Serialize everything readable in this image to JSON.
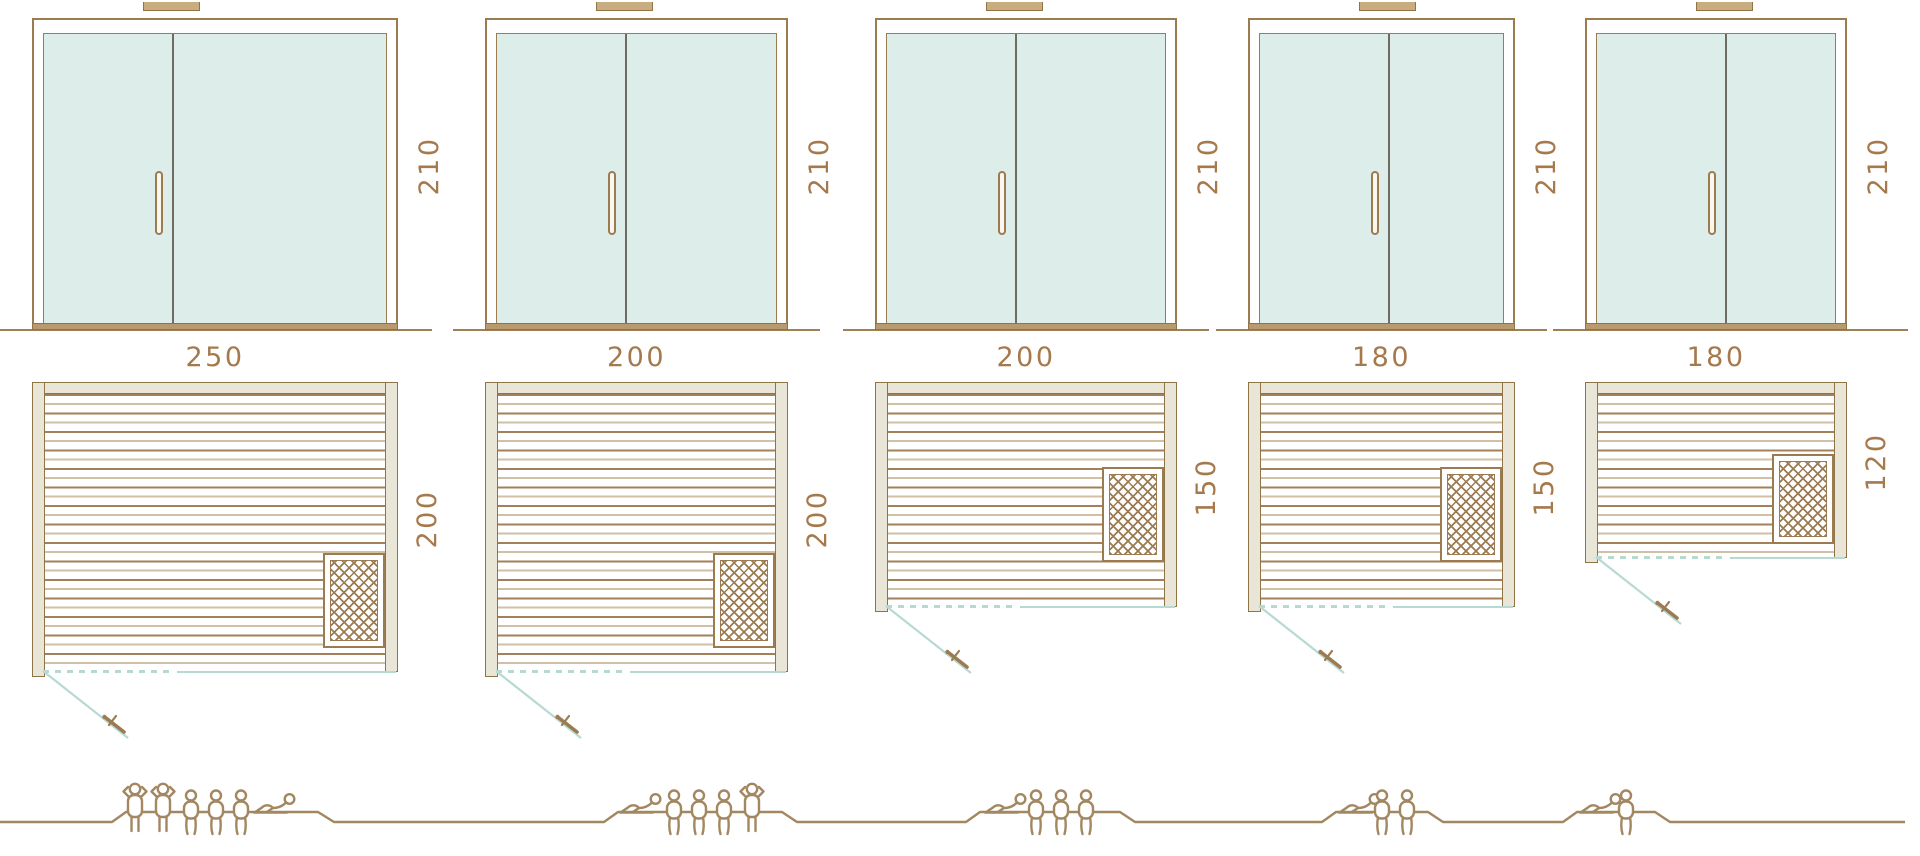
{
  "diagram": {
    "type": "sauna-size-comparison",
    "views": [
      "door-elevation",
      "floor-plan",
      "capacity-figures"
    ]
  },
  "colors": {
    "outline_brown": "#9c7b51",
    "dimension_text": "#a6794d",
    "wood_beige": "#e9e6d7",
    "glass_teal": "#ddeeea",
    "door_swing_teal": "#b7d9d3",
    "figure_brown": "#a28760"
  },
  "icons": {
    "heater": "crosshatch-square",
    "door_swing": "teal-diagonal-with-handle",
    "person_standing": "person-standing-icon",
    "person_sitting": "person-sitting-icon",
    "person_lying": "person-lying-icon"
  },
  "units": [
    {
      "door_height": "210",
      "width": "250",
      "depth": "200",
      "capacity": {
        "standing": 2,
        "sitting": 3,
        "lying": 1
      }
    },
    {
      "door_height": "210",
      "width": "200",
      "depth": "200",
      "capacity": {
        "standing": 1,
        "sitting": 3,
        "lying": 1
      }
    },
    {
      "door_height": "210",
      "width": "200",
      "depth": "150",
      "capacity": {
        "standing": 0,
        "sitting": 3,
        "lying": 1
      }
    },
    {
      "door_height": "210",
      "width": "180",
      "depth": "150",
      "capacity": {
        "standing": 0,
        "sitting": 2,
        "lying": 1
      }
    },
    {
      "door_height": "210",
      "width": "180",
      "depth": "120",
      "capacity": {
        "standing": 0,
        "sitting": 1,
        "lying": 1
      }
    }
  ]
}
